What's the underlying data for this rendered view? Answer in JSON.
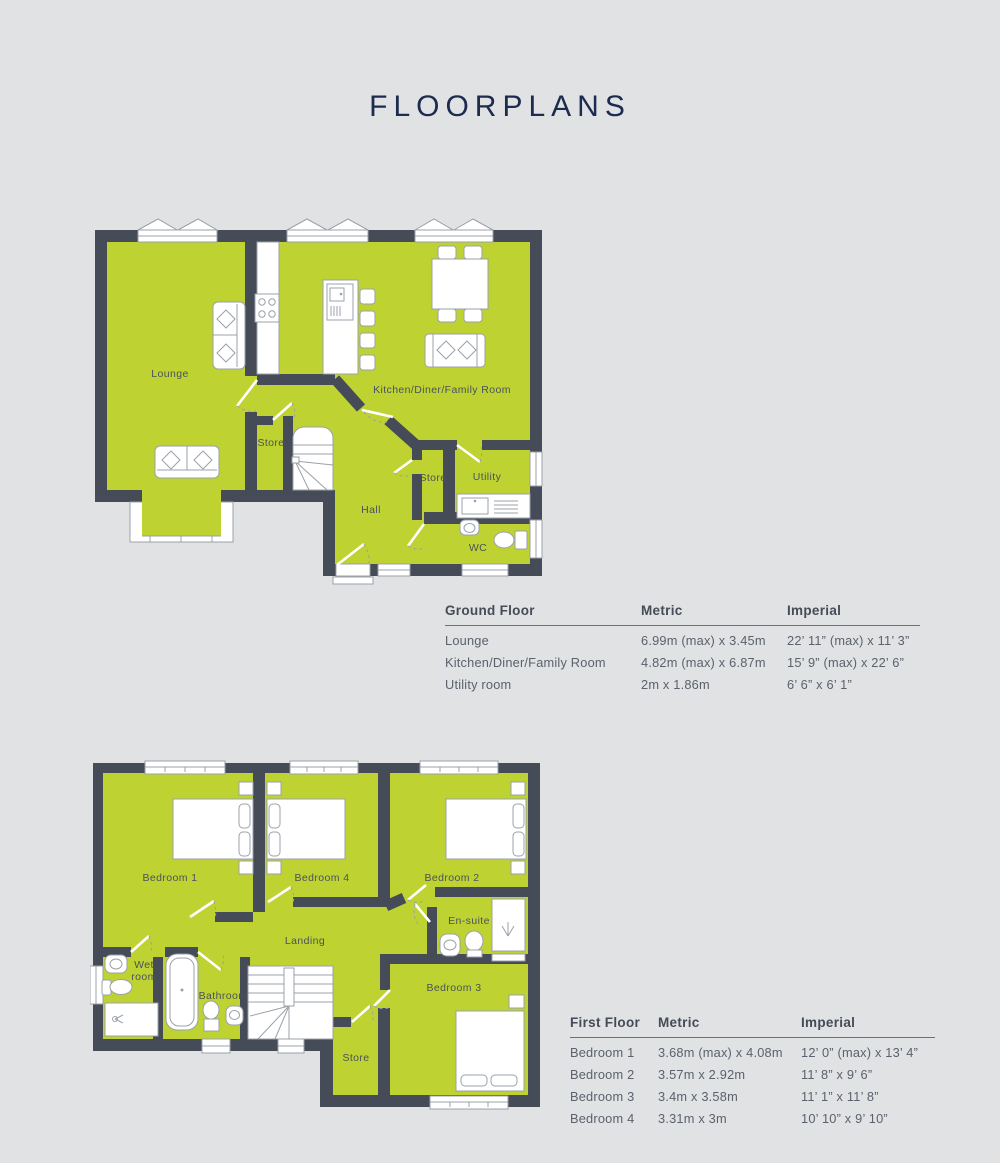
{
  "title": "FLOORPLANS",
  "colors": {
    "background": "#e0e2e3",
    "room_green": "#bed331",
    "wall_slate": "#454b57",
    "title_navy": "#1c2b4e",
    "table_text": "#5b626d"
  },
  "ground_floor": {
    "labels": {
      "lounge": "Lounge",
      "kitchen_diner": "Kitchen/Diner/Family Room",
      "store_1": "Store",
      "store_2": "Store",
      "utility": "Utility",
      "hall": "Hall",
      "wc": "WC"
    },
    "table": {
      "headers": {
        "floor": "Ground Floor",
        "metric": "Metric",
        "imperial": "Imperial"
      },
      "rows": [
        {
          "room": "Lounge",
          "metric": "6.99m (max) x 3.45m",
          "imperial": "22’ 11” (max) x 11’ 3”"
        },
        {
          "room": "Kitchen/Diner/Family Room",
          "metric": "4.82m (max) x 6.87m",
          "imperial": "15’ 9” (max) x 22’ 6”"
        },
        {
          "room": "Utility room",
          "metric": "2m x 1.86m",
          "imperial": "6’ 6” x 6’ 1”"
        }
      ]
    }
  },
  "first_floor": {
    "labels": {
      "bedroom_1": "Bedroom 1",
      "bedroom_2": "Bedroom 2",
      "bedroom_3": "Bedroom 3",
      "bedroom_4": "Bedroom 4",
      "en_suite": "En-suite",
      "landing": "Landing",
      "wet_room_line_1": "Wet",
      "wet_room_line_2": "room",
      "bathroom": "Bathroom",
      "store": "Store"
    },
    "table": {
      "headers": {
        "floor": "First Floor",
        "metric": "Metric",
        "imperial": "Imperial"
      },
      "rows": [
        {
          "room": "Bedroom 1",
          "metric": "3.68m (max) x 4.08m",
          "imperial": "12’ 0” (max) x 13’ 4”"
        },
        {
          "room": "Bedroom 2",
          "metric": "3.57m x 2.92m",
          "imperial": "11’ 8” x 9’ 6”"
        },
        {
          "room": "Bedroom 3",
          "metric": "3.4m x 3.58m",
          "imperial": "11’ 1” x 11’ 8”"
        },
        {
          "room": "Bedroom 4",
          "metric": "3.31m x 3m",
          "imperial": "10’ 10” x 9’ 10”"
        }
      ]
    }
  }
}
